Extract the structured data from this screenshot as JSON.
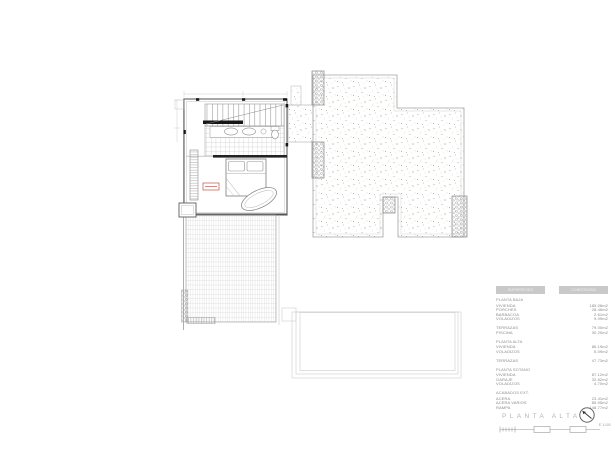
{
  "drawing": {
    "title": "PLANTA ALTA",
    "scale_label": "E 1:100"
  },
  "areas_table": {
    "header": [
      "SUPERFICIES",
      "CONSTRUIDA"
    ],
    "sections": [
      {
        "heading": "PLANTA BAJA",
        "rows": [
          {
            "label": "VIVIENDA",
            "value": "185.08m2"
          },
          {
            "label": "PORCHES",
            "value": "28.46m2"
          },
          {
            "label": "BARBACOA",
            "value": "2.61m2"
          },
          {
            "label": "VOLADIZOS",
            "value": "9.09m2"
          }
        ]
      },
      {
        "heading": "",
        "rows": [
          {
            "label": "TERRAZAS",
            "value": "79.00m2"
          },
          {
            "label": "PISCINA",
            "value": "30.20m2"
          }
        ]
      },
      {
        "heading": "PLANTA ALTA",
        "rows": [
          {
            "label": "VIVIENDA",
            "value": "86.19m2"
          },
          {
            "label": "VOLADIZOS",
            "value": "5.09m2"
          }
        ]
      },
      {
        "heading": "",
        "rows": [
          {
            "label": "TERRAZAS",
            "value": "47.73m2"
          }
        ]
      },
      {
        "heading": "PLANTA SOTANO",
        "rows": [
          {
            "label": "VIVIENDA",
            "value": "87.12m2"
          },
          {
            "label": "GARAJE",
            "value": "32.82m2"
          },
          {
            "label": "VOLADIZOS",
            "value": "4.70m2"
          }
        ]
      },
      {
        "heading": "ACABADOS EXT.",
        "rows": [
          {
            "label": "ACERA",
            "value": "23.41m2"
          },
          {
            "label": "ACERA VARIOS",
            "value": "85.95m2"
          },
          {
            "label": "RAMPA",
            "value": "148.77m2"
          }
        ]
      }
    ]
  },
  "colors": {
    "line_light": "#c4c4c4",
    "line": "#9a9a9a",
    "wall": "#6e6e6e",
    "accent_black": "#161616",
    "label_red": "#c0544c",
    "table_header_bg": "#c9c9c9",
    "title_gray": "#b5b5b5"
  }
}
